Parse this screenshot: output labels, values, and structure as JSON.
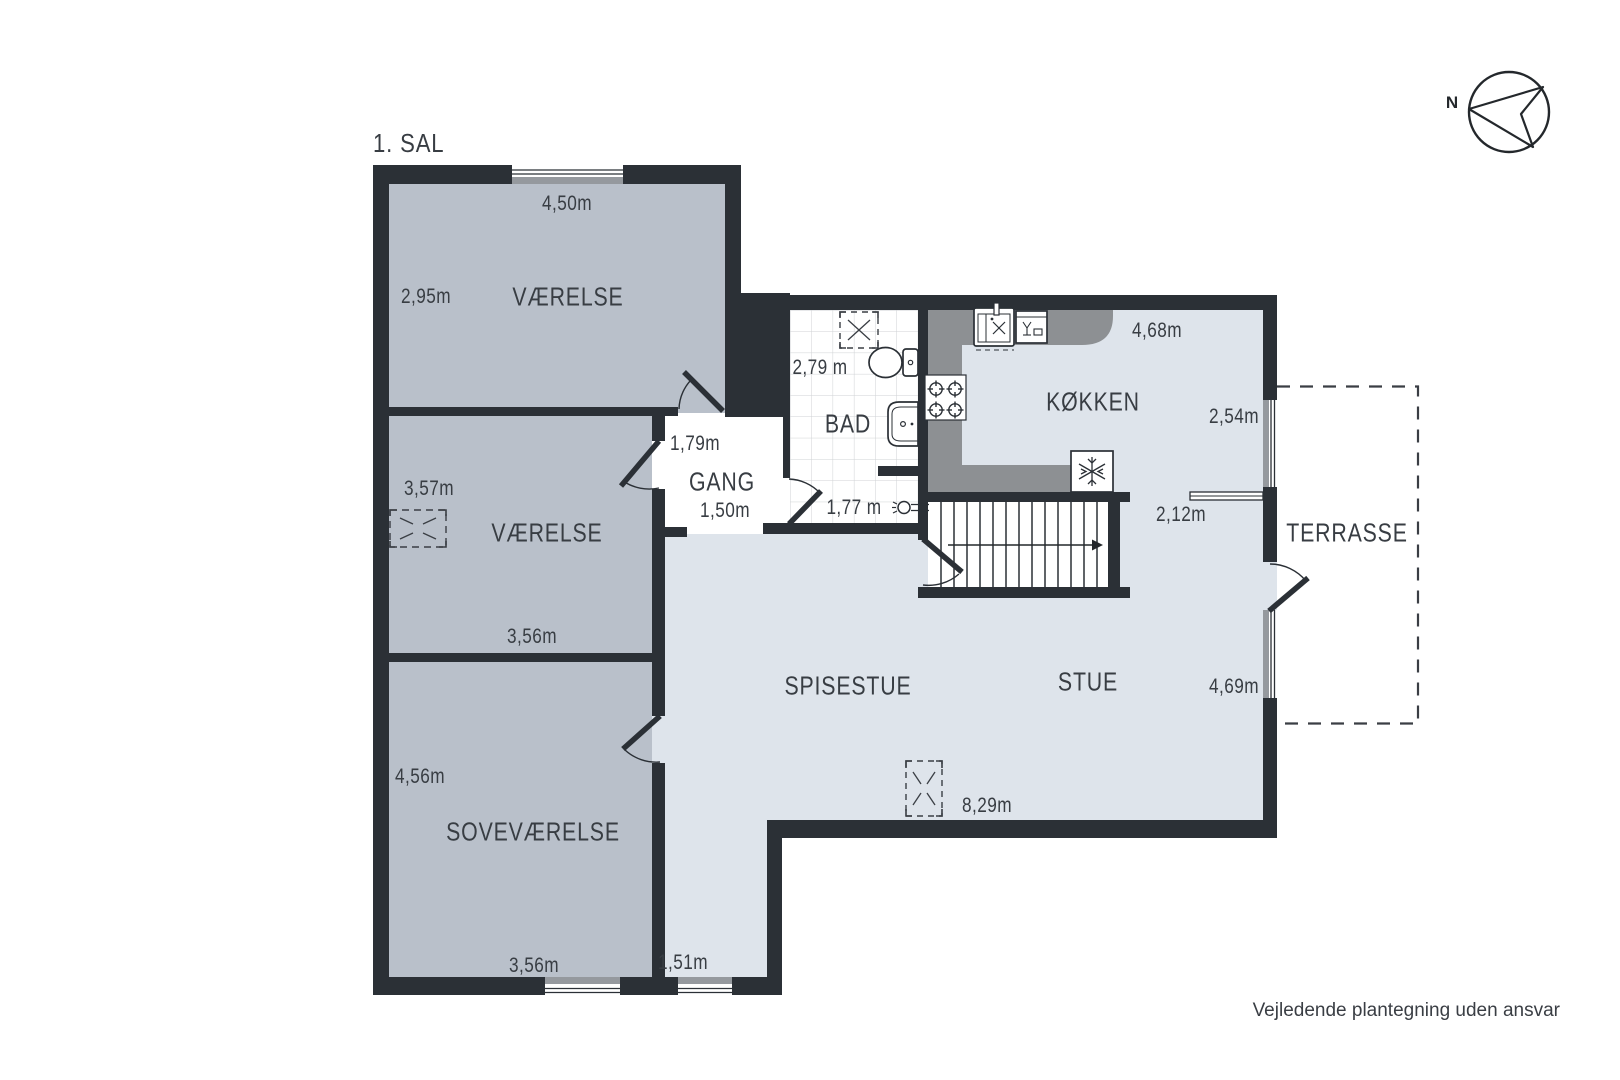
{
  "title": "1. SAL",
  "compass": {
    "north": "N"
  },
  "rooms": {
    "vaerelse_top": {
      "label": "VÆRELSE",
      "dim_width": "4,50m",
      "dim_depth": "2,95m"
    },
    "vaerelse_mid": {
      "label": "VÆRELSE",
      "dim_depth": "3,57m",
      "dim_width": "3,56m"
    },
    "sovevaerelse": {
      "label": "SOVEVÆRELSE",
      "dim_depth": "4,56m",
      "dim_width": "3,56m"
    },
    "gang": {
      "label": "GANG",
      "dim_width": "1,79m",
      "dim_depth": "1,50m"
    },
    "bad": {
      "label": "BAD",
      "dim_width": "2,79 m",
      "dim_shower": "1,77 m"
    },
    "koekken": {
      "label": "KØKKEN",
      "dim_width": "4,68m",
      "dim_window": "2,54m",
      "dim_ledge": "2,12m"
    },
    "spisestue": {
      "label": "SPISESTUE",
      "dim_width": "8,29m",
      "dim_hall": "1,51m"
    },
    "stue": {
      "label": "STUE",
      "dim_window": "4,69m"
    },
    "terrasse": {
      "label": "TERRASSE"
    }
  },
  "footer": {
    "disclaimer": "Vejledende plantegning uden ansvar"
  },
  "colors": {
    "wall": "#2b3036",
    "room_gray_fill": "#b9c0ca",
    "room_blue_fill": "#dee4eb",
    "kitchen_counter": "#8d9093",
    "window_sill": "#95999e",
    "text": "#383d43"
  }
}
